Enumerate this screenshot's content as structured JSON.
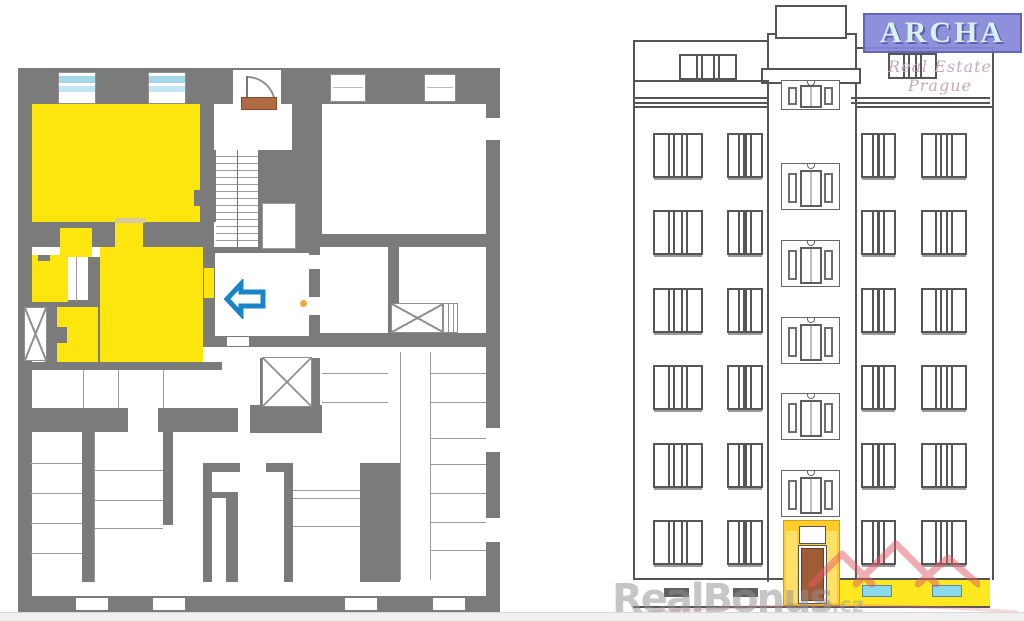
{
  "branding": {
    "logo_text": "ARCHA",
    "logo_subtitle": "Real Estate Prague",
    "logo_bg_color": "#8587d9",
    "logo_text_color": "#d8f2f0",
    "subtitle_color": "#c7a9bd"
  },
  "watermark": {
    "text": "RealBonus",
    "suffix": ".cz",
    "text_color": "rgba(145,145,145,0.52)",
    "roof_icon_color": "rgba(224,90,100,0.5)"
  },
  "floor_plan": {
    "highlight_color": "#fde60d",
    "wall_color": "#7b7b7b",
    "window_glass_color": "#a4d7ea",
    "entrance_arrow_color": "#1b84c6",
    "entrance_arrow_direction": "left",
    "entrance_door_color": "#b06a43",
    "shaft_count": 4
  },
  "elevation": {
    "floors_visible": 7,
    "main_window_rows": 6,
    "window_columns": 4,
    "staircase_window_count": 5,
    "entrance_highlight_color": "#ffcd2a",
    "entrance_door_color": "#a05c36",
    "basement_strip_color": "#ffe820",
    "basement_window_color": "#8ad9ec"
  }
}
